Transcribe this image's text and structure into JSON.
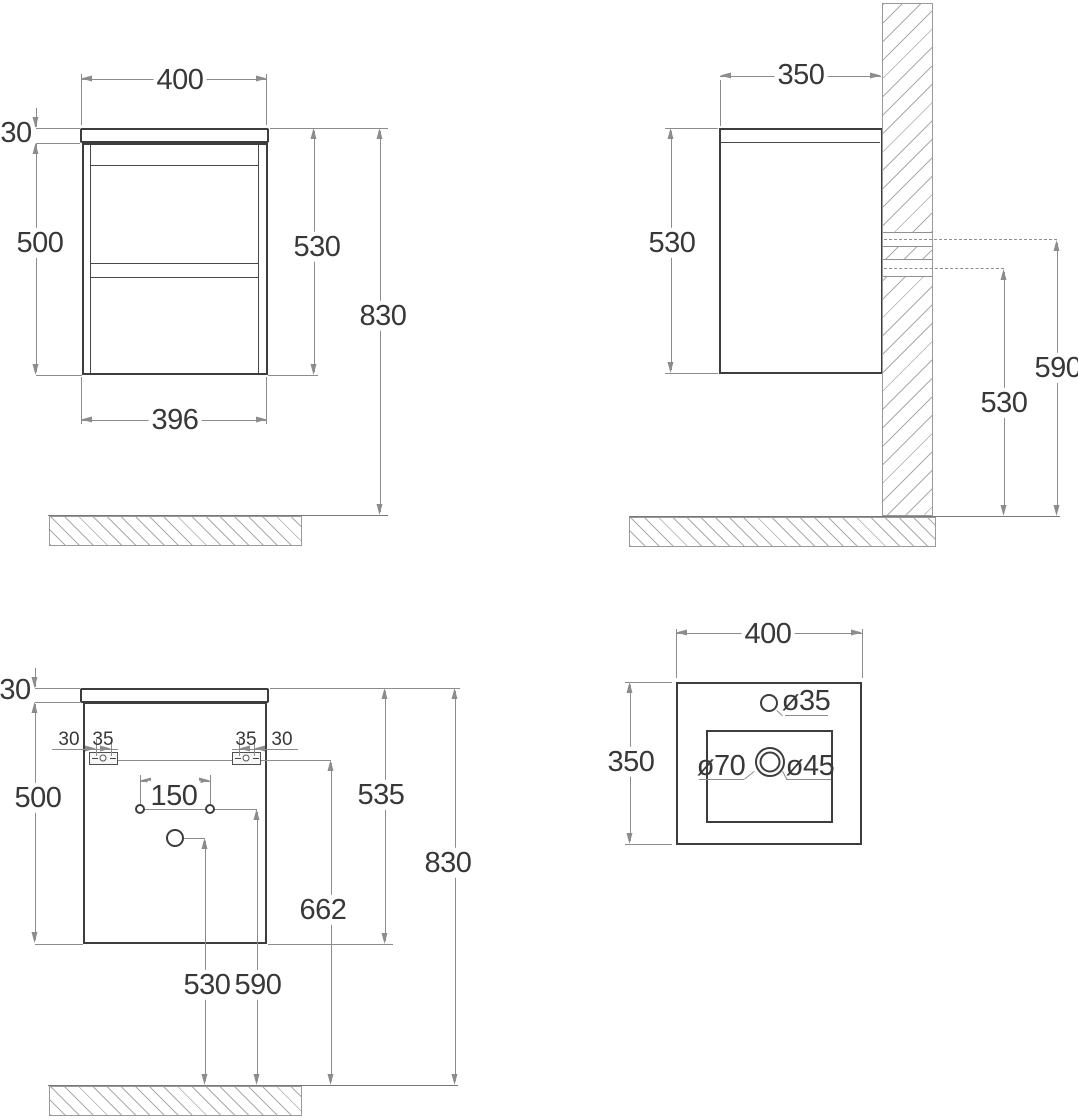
{
  "views": {
    "front": {
      "width_top": "400",
      "top_thickness": "30",
      "body_height": "500",
      "cabinet_height": "530",
      "total_height": "830",
      "body_width": "396"
    },
    "side": {
      "depth": "350",
      "cabinet_height": "530",
      "upper_fixing_height": "590",
      "lower_fixing_height": "530"
    },
    "back": {
      "top_thickness": "30",
      "body_height": "500",
      "bracket_offset_left": "30",
      "bracket_screw_left": "35",
      "bracket_screw_right": "35",
      "bracket_offset_right": "30",
      "holes_spacing": "150",
      "cabinet_height": "535",
      "brackets_height": "662",
      "total_height": "830",
      "drain_height": "530",
      "holes_height": "590"
    },
    "basin": {
      "width": "400",
      "depth": "350",
      "faucet_hole": "ø35",
      "drain_outer": "ø70",
      "drain_inner": "ø45"
    }
  }
}
